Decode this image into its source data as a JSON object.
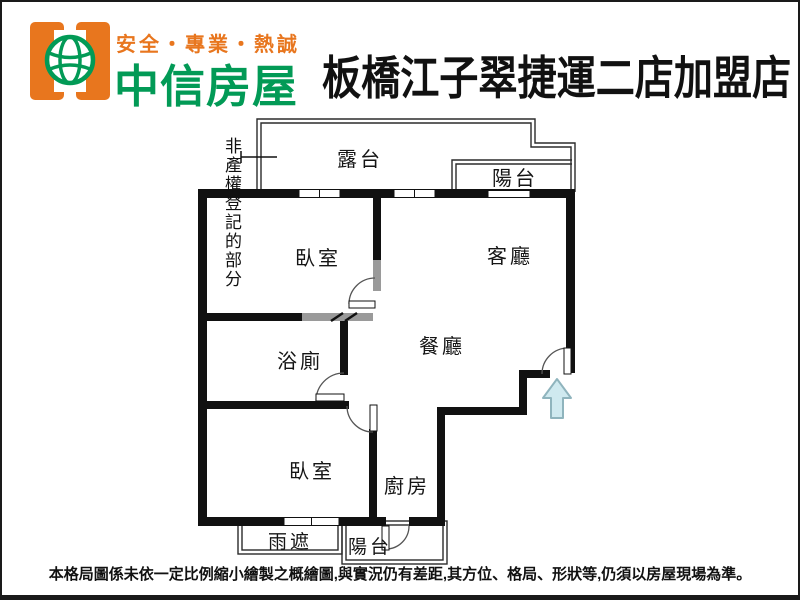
{
  "header": {
    "slogan": "安全・專業・熱誠",
    "brand": "中信房屋",
    "store_title": "板橋江子翠捷運二店加盟店",
    "colors": {
      "orange": "#e8761e",
      "green": "#029a56",
      "title": "#111111"
    }
  },
  "floorplan": {
    "annotation_label": "非產權登記的部分",
    "rooms": {
      "terrace": "露台",
      "balcony_top": "陽台",
      "bedroom_top": "臥室",
      "living_room": "客廳",
      "dining_room": "餐廳",
      "bathroom": "浴廁",
      "bedroom_bottom": "臥室",
      "kitchen": "廚房",
      "rain_cover": "雨遮",
      "balcony_bottom": "陽台"
    },
    "entrance_arrow": {
      "direction": "up",
      "fill": "#cfe9ef",
      "border": "#8fb4bd"
    },
    "wall_color": "#111111",
    "gray_wall_color": "#9a9a9a"
  },
  "footer": {
    "disclaimer": "本格局圖係未依一定比例縮小繪製之概繪圖,與實況仍有差距,其方位、格局、形狀等,仍須以房屋現場為準。"
  }
}
